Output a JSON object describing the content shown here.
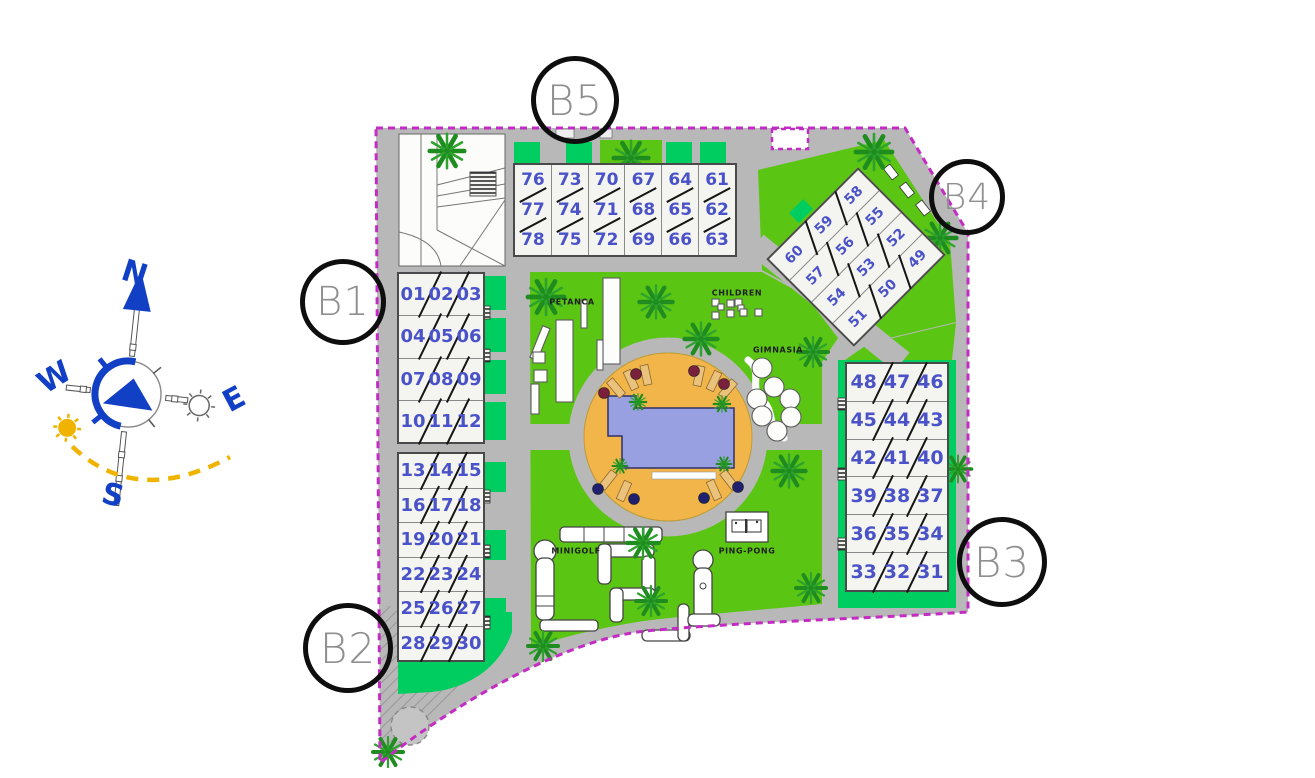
{
  "plan": {
    "block_labels": {
      "b1": "B1",
      "b2": "B2",
      "b3": "B3",
      "b4": "B4",
      "b5": "B5"
    },
    "buildings": {
      "b5": {
        "block": "B5",
        "columns": [
          [
            "76",
            "77",
            "78"
          ],
          [
            "73",
            "74",
            "75"
          ],
          [
            "70",
            "71",
            "72"
          ],
          [
            "67",
            "68",
            "69"
          ],
          [
            "64",
            "65",
            "66"
          ],
          [
            "61",
            "62",
            "63"
          ]
        ]
      },
      "b4": {
        "block": "B4",
        "rows": [
          [
            "60",
            "59",
            "58"
          ],
          [
            "57",
            "56",
            "55"
          ],
          [
            "54",
            "53",
            "52"
          ],
          [
            "51",
            "50",
            "49"
          ]
        ]
      },
      "b1": {
        "block": "B1",
        "rows": [
          [
            "01",
            "02",
            "03"
          ],
          [
            "04",
            "05",
            "06"
          ],
          [
            "07",
            "08",
            "09"
          ],
          [
            "10",
            "11",
            "12"
          ]
        ]
      },
      "b2": {
        "block": "B2",
        "rows": [
          [
            "13",
            "14",
            "15"
          ],
          [
            "16",
            "17",
            "18"
          ],
          [
            "19",
            "20",
            "21"
          ],
          [
            "22",
            "23",
            "24"
          ],
          [
            "25",
            "26",
            "27"
          ],
          [
            "28",
            "29",
            "30"
          ]
        ]
      },
      "b3": {
        "block": "B3",
        "rows": [
          [
            "48",
            "47",
            "46"
          ],
          [
            "45",
            "44",
            "43"
          ],
          [
            "42",
            "41",
            "40"
          ],
          [
            "39",
            "38",
            "37"
          ],
          [
            "36",
            "35",
            "34"
          ],
          [
            "33",
            "32",
            "31"
          ]
        ]
      }
    },
    "amenities": {
      "petanca": "PETANCA",
      "children": "CHILDREN",
      "gimnasia": "GIMNASIA",
      "minigolf": "MINIGOLF",
      "ping_pong": "PING-PONG"
    },
    "compass": {
      "north": "N",
      "south": "S",
      "east": "E",
      "west": "W"
    },
    "colors": {
      "lawn": "#5bc514",
      "emerald": "#00cd5f",
      "road": "#b8b8b8",
      "boundary": "#c32cc3",
      "pool_deck": "#f2b54a",
      "pool_water": "#98a0e2",
      "unit_number": "#4a52c8",
      "compass_blue": "#1240c4",
      "sun_yellow": "#f0b400"
    }
  }
}
